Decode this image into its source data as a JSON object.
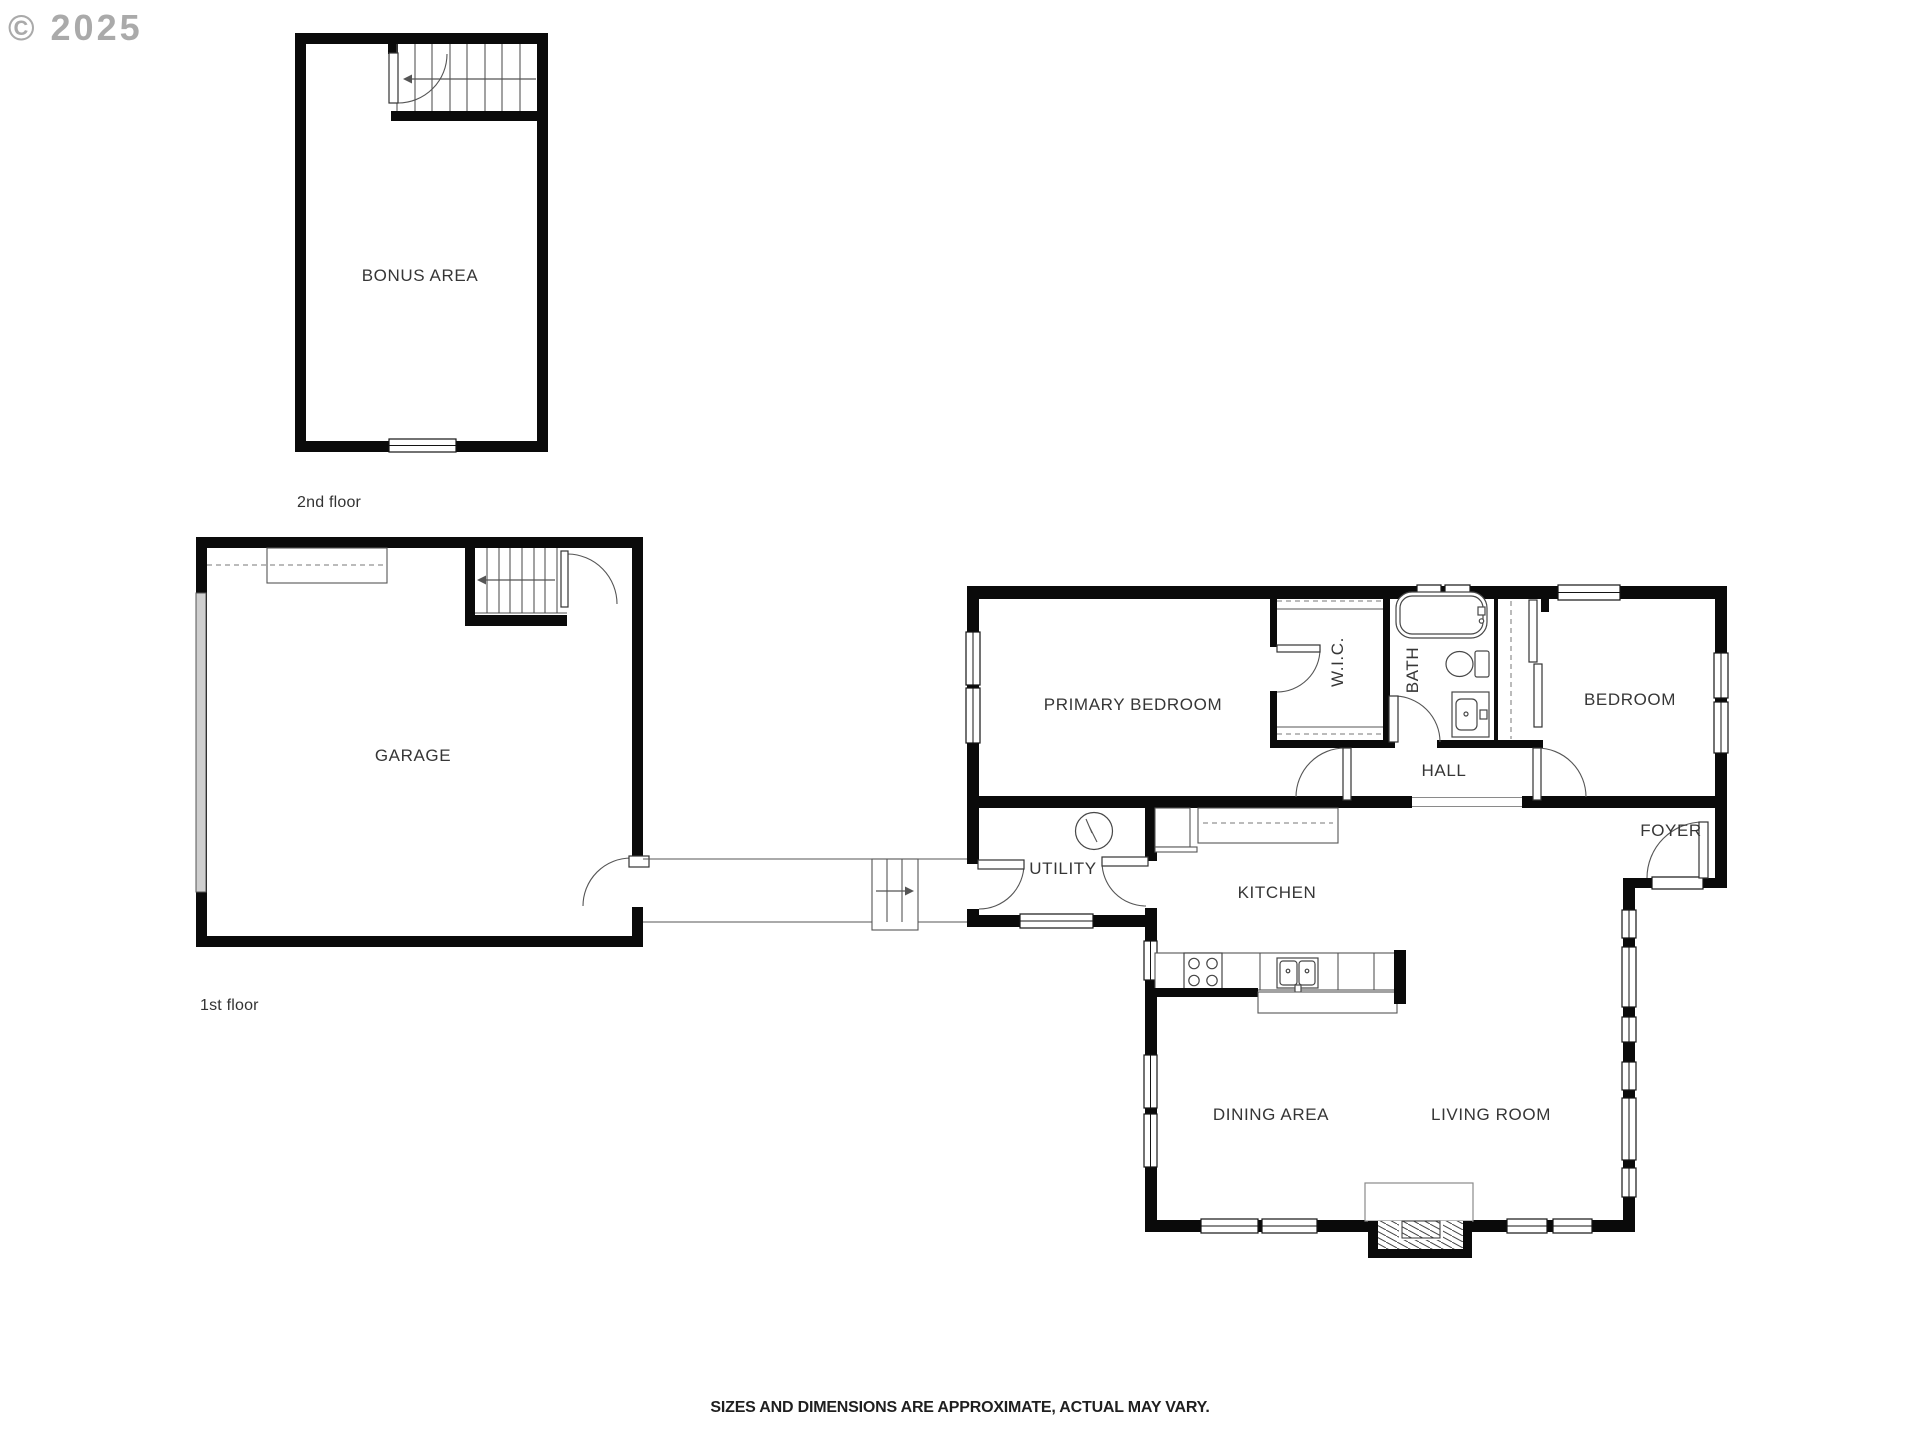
{
  "watermark": {
    "text": "© 2025",
    "color": "#9c9c9c"
  },
  "colors": {
    "wall": "#0a0a0a",
    "label": "#363636",
    "garage_door": "#cfcfcf",
    "thin_line": "#555555"
  },
  "floors": {
    "second": {
      "label": "2nd floor",
      "rooms": {
        "bonus_area": "BONUS AREA"
      }
    },
    "first": {
      "label": "1st floor",
      "rooms": {
        "garage": "GARAGE",
        "primary_bedroom": "PRIMARY BEDROOM",
        "wic": "W.I.C.",
        "bath": "BATH",
        "bedroom": "BEDROOM",
        "hall": "HALL",
        "foyer": "FOYER",
        "utility": "UTILITY",
        "kitchen": "KITCHEN",
        "dining_area": "DINING AREA",
        "living_room": "LIVING ROOM"
      }
    }
  },
  "disclaimer": "SIZES AND DIMENSIONS ARE APPROXIMATE, ACTUAL MAY VARY."
}
